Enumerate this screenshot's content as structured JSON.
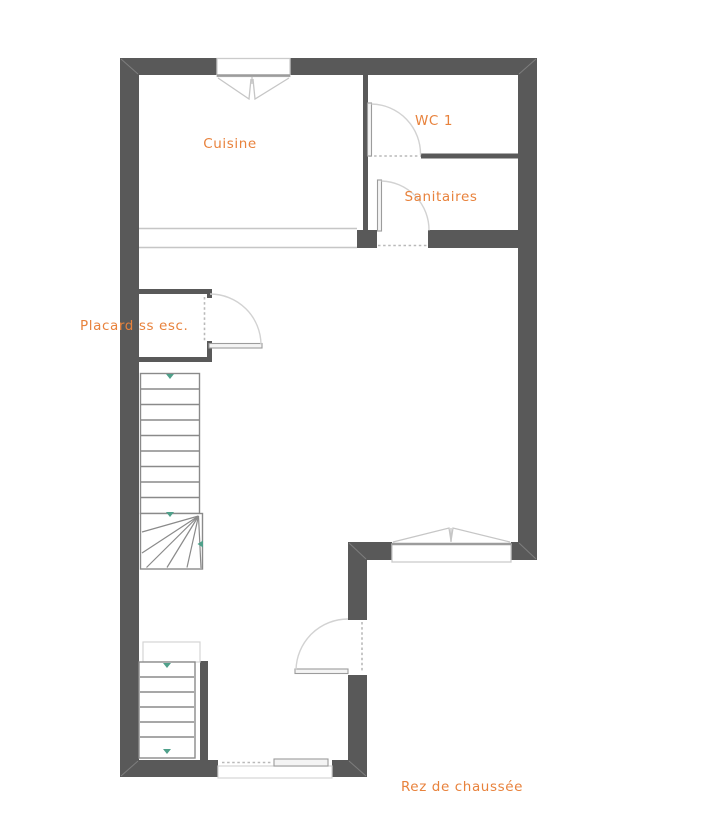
{
  "plan": {
    "floor_label": "Rez de chaussée",
    "rooms": {
      "cuisine": "Cuisine",
      "wc1": "WC 1",
      "sanitaires": "Sanitaires",
      "placard": "Placard ss esc."
    },
    "colors": {
      "wall": "#595959",
      "room_label": "#E8823C",
      "stair_outline": "#8a8a8a",
      "door_arc": "#d2d2d2",
      "window_frame": "#cbcbcb",
      "direction_arrow": "#4fa08a",
      "background": "#ffffff"
    }
  }
}
